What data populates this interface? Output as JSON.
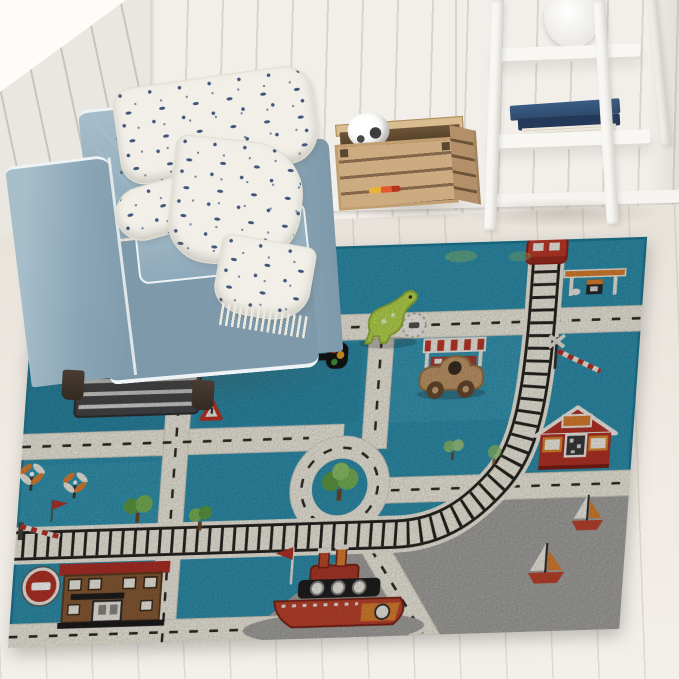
{
  "image": {
    "description": "Kids city-road play rug (teal, white and grey with race track, railway, harbor, houses and vehicles) styled in a bright nursery corner with a slate-blue tufted armchair, a patterned throw blanket, a wooden toy crate holding a soccer ball, and a white ladder shelf with a vase and navy books.",
    "width": 679,
    "height": 679
  },
  "colors": {
    "wall": "#f2efea",
    "wallL": "#eae6e0",
    "window": "#fdfcf9",
    "shelfWhite": "#f8f7f4",
    "book": "#2e4a6b",
    "chair": "#8ba7b7",
    "chairDark": "#7e99aa",
    "chairLight": "#a6bdca",
    "piping": "#eef3f5",
    "blanketInk": "#41557c",
    "rugTeal": "#2f91ae",
    "rugTealDark": "#27809d",
    "rugTealLight": "#3fa2bd",
    "road": "#f2eee2",
    "roadDash": "#2e2c28",
    "trackGray": "#9b9da0",
    "harbor": "#a6a5a2",
    "red": "#b63327",
    "trainRed": "#c13a2a",
    "orange": "#dd8130",
    "brown": "#8a5c36",
    "darkBld": "#47474a",
    "green": "#5f9c44",
    "greenLight": "#8fbf6a",
    "toyBlue": "#2b57c0",
    "toyWood": "#c49a6a",
    "dino": "#b9d84f",
    "boatRed": "#c0442e"
  },
  "room": {
    "wall": "white shiplap planks with corner seam",
    "window_light": "daylight wedge, top-left",
    "floor": "whitewashed oak planks"
  },
  "furniture": {
    "armchair": "slate-blue tufted cube armchair with white piping and dark wood feet",
    "blanket": "cream throw with navy botanical print and fringed end",
    "crate": "natural wood slatted toy crate",
    "crate_contents": [
      "soccer ball",
      "orange-and-yellow toy stick"
    ],
    "ladder_shelf": "white leaning ladder shelf",
    "shelf_items": [
      "white gourd vase",
      "stack of navy-blue books"
    ]
  },
  "rug": {
    "theme": "children's teal city traffic play rug with grey harbor",
    "features": [
      "grey race track with checkered finish and red-white curbs",
      "railway with red train engine",
      "gas station with orange canopy",
      "roundabout with tree",
      "white roads with dashed lines",
      "level-crossing barriers",
      "windmills",
      "no-entry sign",
      "yield sign",
      "traffic light",
      "striped market stall",
      "dark city building with red sign",
      "brown station house with red roof",
      "red barn house",
      "grey harbor with tug boat and two sailboats",
      "scattered green trees"
    ],
    "toys_on_rug": [
      "blue wooden toy truck",
      "lime-green dinosaur figure",
      "natural wooden toy car"
    ]
  }
}
